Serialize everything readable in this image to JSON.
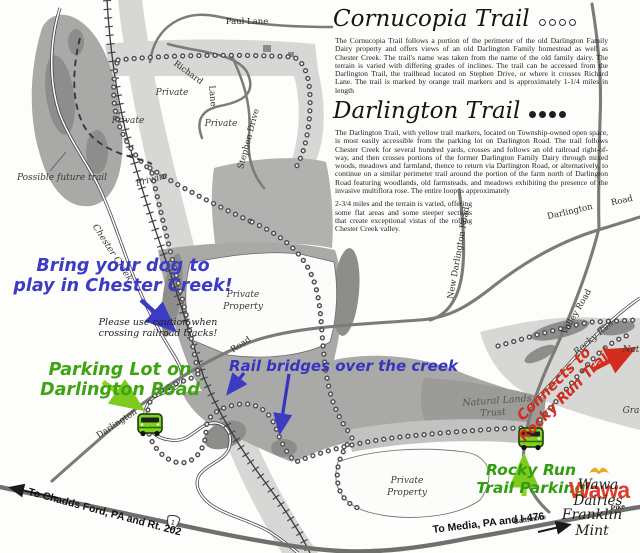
{
  "title_block": {
    "cornucopia": {
      "title": "Cornucopia Trail",
      "marker_style": "open circles",
      "body": "The Cornucopia Trail follows a portion of the perimeter of the old Darlington Family Dairy property and offers views of an old Darlington Family homestead as well as Chester Creek. The trail's name was taken from the name of the old family dairy. The terrain is varied with differing grades of inclines. The trail can be accessed from the Darlington Trail, the trailhead located on Stephen Drive, or where it crosses Richard Lane. The trail is marked by orange trail markers and is approximately 1-1/4 miles in length"
    },
    "darlington": {
      "title": "Darlington Trail",
      "marker_style": "filled circles",
      "body_1": "The Darlington Trail, with yellow trail markers, located on Township-owned open space, is most easily accessible from the parking lot on Darlington Road. The trail follows Chester Creek for several hundred yards, crosses and follows an old railroad right-of-way, and then crosses portions of the former Darlington Family Dairy through mixed woods, meadows and farmland, thence to return via Darlington Road, or alternatively, to continue on a similar perimeter trail around the portion of the farm north of Darlington Road featuring woodlands, old farmsteads, and meadows exhibiting the presence of the invasive multiflora rose. The entire loop is approximately",
      "body_2": "2-3/4 miles and the terrain is varied, offering some flat areas and some steeper sections that create exceptional vistas of the rolling Chester Creek valley."
    }
  },
  "annotations": {
    "dog_note": "Bring your dog to\nplay in Chester Creek!",
    "caution_note": "Please use caution when\ncrossing railroad tracks!",
    "parking_note": "Parking Lot on\nDarlington Road",
    "bridges_note": "Rail bridges over the creek",
    "connects_note": "Connects to\nRocky Run Trail",
    "rocky_parking_note": "Rocky Run\nTrail Parking",
    "wawa_logo_text": "Wawa",
    "wawa_dairies": "Wawa\nDairies",
    "franklin_mint": "Franklin\nMint",
    "to_chadds": "To Chadds Ford, PA and Rt. 202",
    "to_media": "To Media, PA and I-476",
    "route_shield": "1"
  },
  "map_labels": [
    {
      "name": "label-paul-lane",
      "cls": "road",
      "text": "Paul Lane",
      "x": 247,
      "y": 22,
      "rot": 0
    },
    {
      "name": "label-richard",
      "cls": "road",
      "text": "Richard",
      "x": 188,
      "y": 73,
      "rot": 36
    },
    {
      "name": "label-richard-lane",
      "cls": "road",
      "text": "Lane",
      "x": 212,
      "y": 96,
      "rot": 85
    },
    {
      "name": "label-private-1",
      "cls": "it",
      "text": "Private",
      "x": 172,
      "y": 93,
      "rot": 0
    },
    {
      "name": "label-private-2",
      "cls": "it",
      "text": "Private",
      "x": 128,
      "y": 121,
      "rot": 0
    },
    {
      "name": "label-private-3",
      "cls": "it",
      "text": "Private",
      "x": 221,
      "y": 124,
      "rot": 0
    },
    {
      "name": "label-private-4",
      "cls": "it",
      "text": "Private",
      "x": 152,
      "y": 180,
      "rot": -15
    },
    {
      "name": "label-possible-future-trail",
      "cls": "it",
      "text": "Possible future trail",
      "x": 62,
      "y": 178,
      "rot": 0
    },
    {
      "name": "label-stephen-drive",
      "cls": "road",
      "text": "Stephen Drive",
      "x": 249,
      "y": 139,
      "rot": -75
    },
    {
      "name": "label-chester-creek",
      "cls": "it",
      "text": "Chester Creek",
      "x": 112,
      "y": 253,
      "rot": 57
    },
    {
      "name": "label-private-property-1a",
      "cls": "it",
      "text": "Private",
      "x": 243,
      "y": 295,
      "rot": 0
    },
    {
      "name": "label-private-property-1b",
      "cls": "it",
      "text": "Property",
      "x": 243,
      "y": 307,
      "rot": 0
    },
    {
      "name": "label-road-1",
      "cls": "road",
      "text": "Road",
      "x": 241,
      "y": 345,
      "rot": -33
    },
    {
      "name": "label-darlington-1",
      "cls": "road",
      "text": "Darlington",
      "x": 117,
      "y": 424,
      "rot": -33
    },
    {
      "name": "label-new-darlington-road",
      "cls": "road",
      "text": "New Darlington Road",
      "x": 459,
      "y": 253,
      "rot": -80
    },
    {
      "name": "label-darlington-2",
      "cls": "road",
      "text": "Darlington",
      "x": 570,
      "y": 212,
      "rot": -13
    },
    {
      "name": "label-road-2",
      "cls": "road",
      "text": "Road",
      "x": 622,
      "y": 201,
      "rot": -13
    },
    {
      "name": "label-valley-road",
      "cls": "road",
      "text": "Valley Road",
      "x": 577,
      "y": 312,
      "rot": -60
    },
    {
      "name": "label-rocky-run",
      "cls": "it",
      "text": "Rocky Run",
      "x": 594,
      "y": 338,
      "rot": -40
    },
    {
      "name": "label-natural-lands-1",
      "cls": "it-lt",
      "text": "Natural Lands",
      "x": 497,
      "y": 401,
      "rot": -4
    },
    {
      "name": "label-natural-lands-2",
      "cls": "it-lt",
      "text": "Trust",
      "x": 493,
      "y": 413,
      "rot": -4
    },
    {
      "name": "label-natur-cutoff",
      "cls": "it",
      "text": "Natur",
      "x": 636,
      "y": 350,
      "rot": 0
    },
    {
      "name": "label-gra-cutoff",
      "cls": "it",
      "text": "Gra",
      "x": 631,
      "y": 411,
      "rot": 0
    },
    {
      "name": "label-private-property-2a",
      "cls": "it",
      "text": "Private",
      "x": 407,
      "y": 481,
      "rot": 0
    },
    {
      "name": "label-private-property-2b",
      "cls": "it",
      "text": "Property",
      "x": 407,
      "y": 493,
      "rot": 0
    },
    {
      "name": "label-baltimore",
      "cls": "sm",
      "text": "Baltimore",
      "x": 530,
      "y": 520,
      "rot": -9
    },
    {
      "name": "label-pike",
      "cls": "sm",
      "text": "Pike",
      "x": 618,
      "y": 508,
      "rot": -8
    }
  ],
  "colors": {
    "annotation_blue": "#3b3bc4",
    "annotation_green": "#3fa411",
    "annotation_red": "#d22d1e",
    "wawa_red": "#e03c2e",
    "goose_gold": "#eca81e",
    "car_green": "#7ed321",
    "woods_gray": "#a9a9a7"
  }
}
